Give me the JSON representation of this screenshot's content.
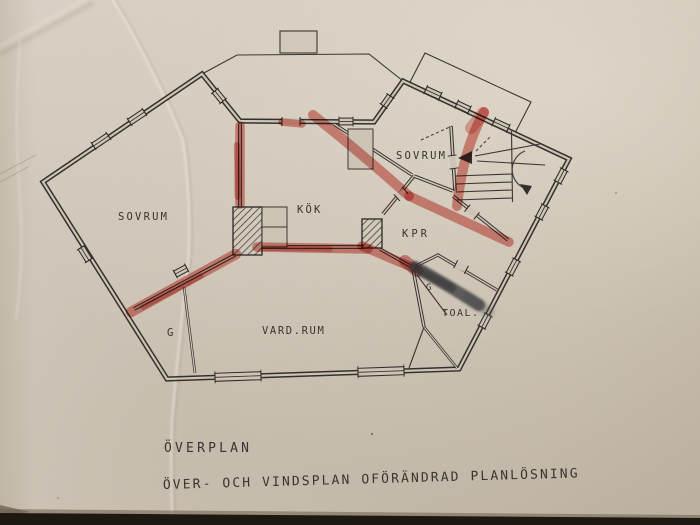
{
  "paper": {
    "color": "#cfc6b9",
    "line_color": "#2a2723"
  },
  "annotations": {
    "marker_color": "#d03024",
    "smudge_color": "#343236"
  },
  "rooms": [
    {
      "id": "sovrum-left",
      "label": "SOVRUM"
    },
    {
      "id": "kok",
      "label": "KÖK"
    },
    {
      "id": "sovrum-right",
      "label": "SOVRUM"
    },
    {
      "id": "kpr",
      "label": "KPR"
    },
    {
      "id": "vardrum",
      "label": "VARD.RUM"
    },
    {
      "id": "g-left",
      "label": "G"
    },
    {
      "id": "g-right",
      "label": "G"
    },
    {
      "id": "toal",
      "label": "TOAL."
    }
  ],
  "captions": {
    "plan": "ÖVERPLAN",
    "note": "ÖVER- OCH VINDSPLAN OFÖRÄNDRAD PLANLÖSNING"
  }
}
